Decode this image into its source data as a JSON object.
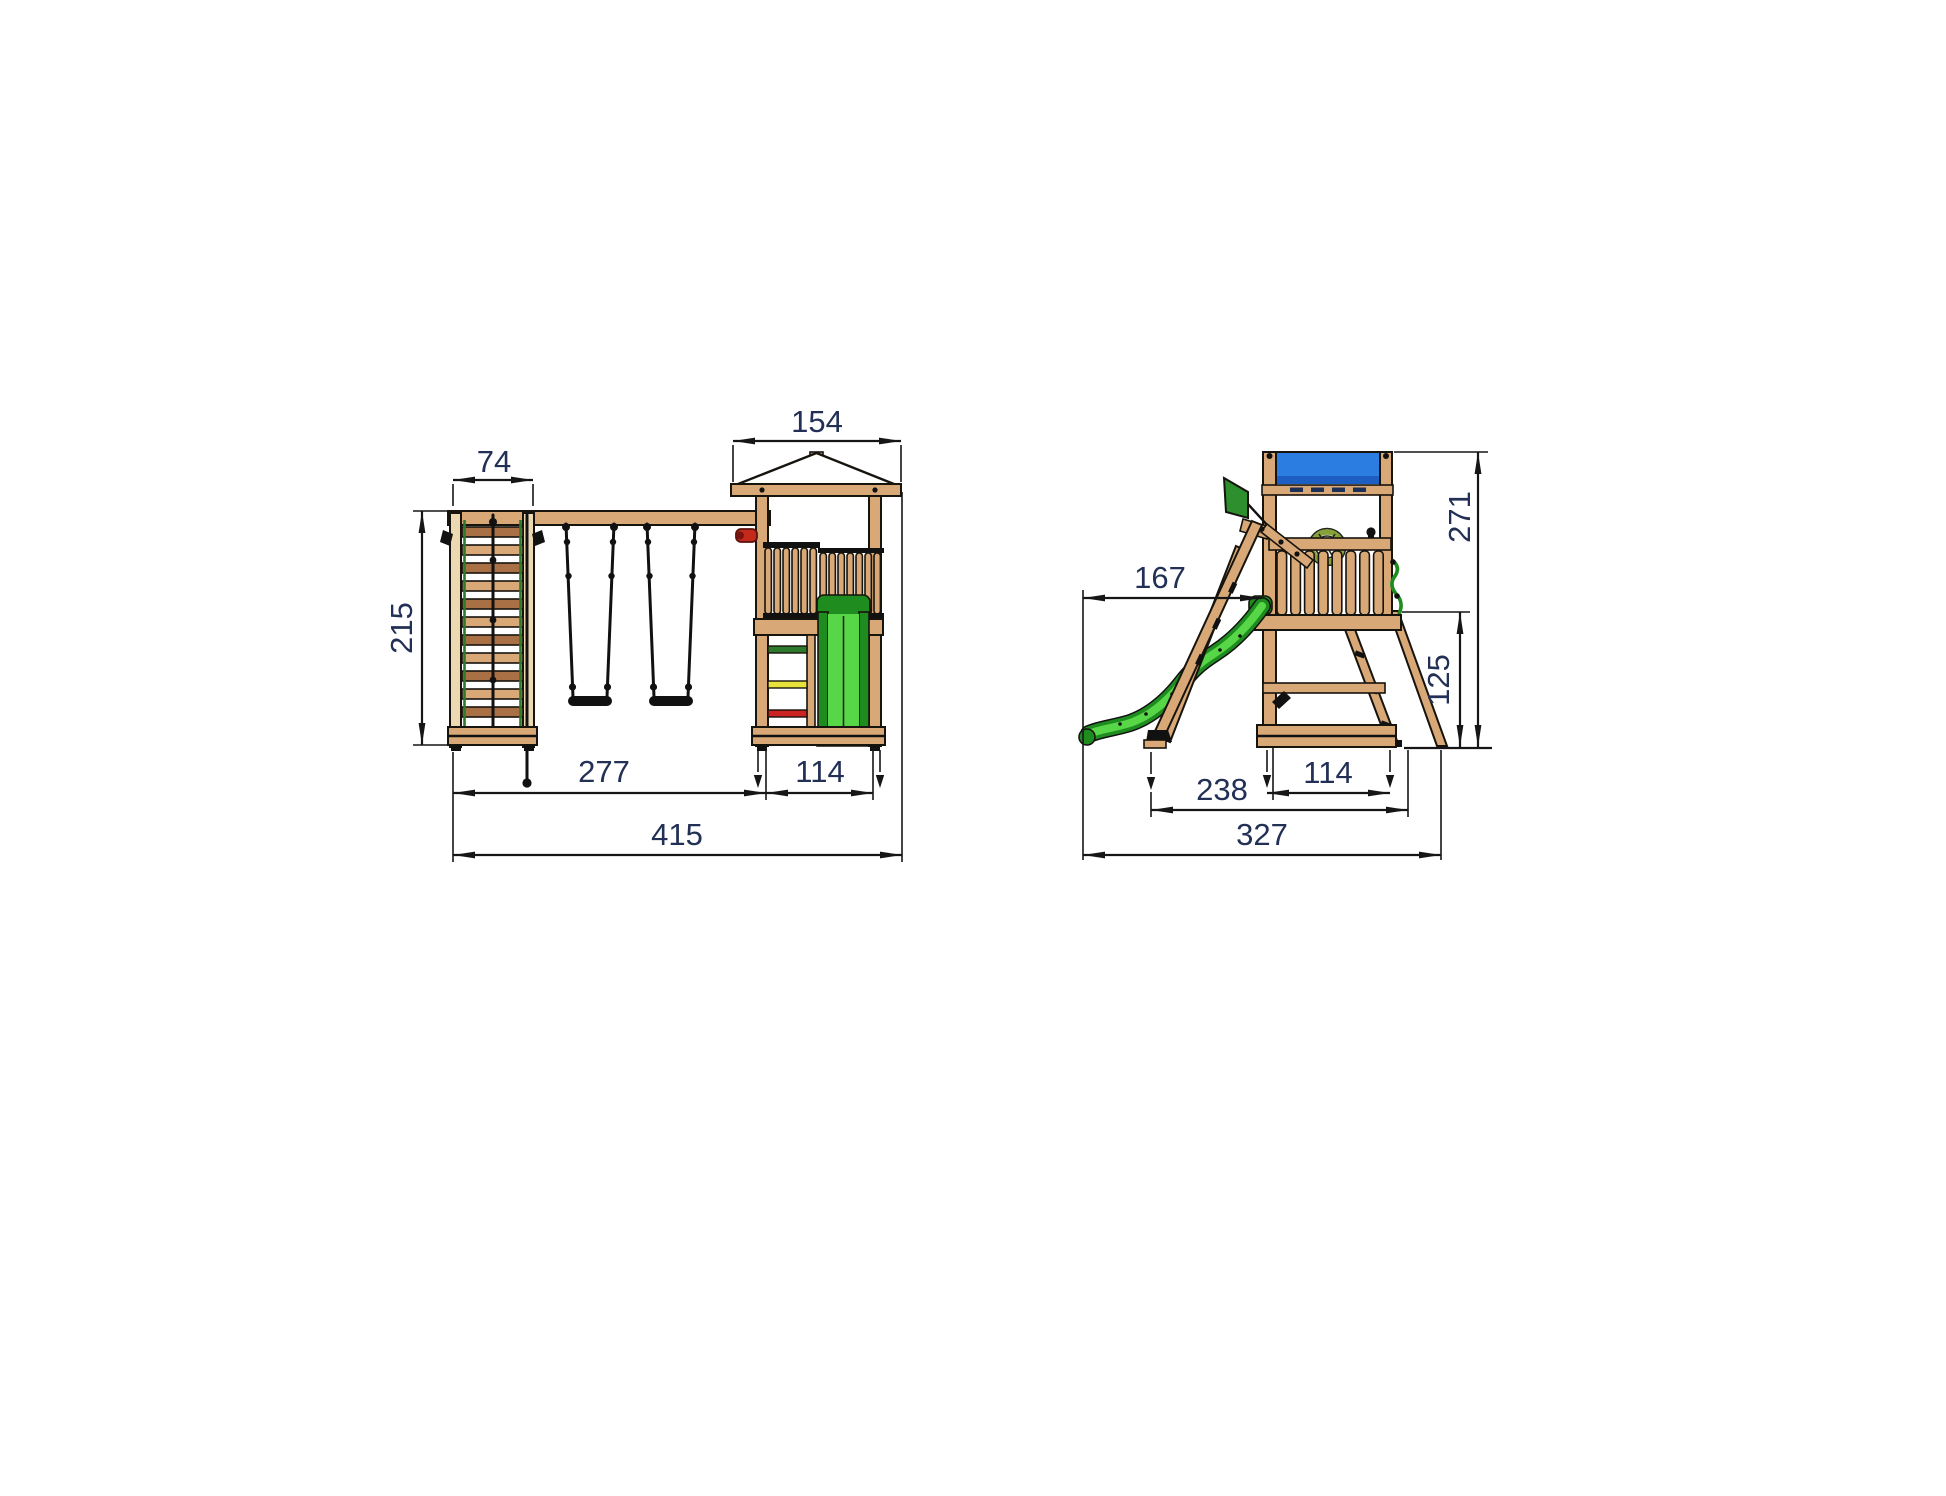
{
  "front_view": {
    "dims": {
      "frame_width": "74",
      "roof_width": "154",
      "height": "215",
      "swing_span": "277",
      "tower_width": "114",
      "total_width": "415"
    }
  },
  "side_view": {
    "dims": {
      "slide_reach": "167",
      "total_height": "271",
      "platform_height": "125",
      "ladder_depth": "238",
      "tower_depth": "114",
      "total_depth": "327"
    }
  },
  "colors": {
    "wood": "#d8a877",
    "wood_light": "#ecd9b2",
    "wood_dark": "#a97046",
    "outline": "#17130d",
    "dimension_text": "#223055",
    "dimension_line": "#161616",
    "slide_green": "#57d648",
    "slide_green_dark": "#1f8c1f",
    "banner_blue": "#2b7de2",
    "banner_blue_dark": "#1d5ec2",
    "flag_green": "#2d8f2d",
    "wheel_green": "#86a135",
    "grip_red": "#c42a1c",
    "rung_yellow": "#e8e23a",
    "rung_red": "#cc2222",
    "rung_green": "#2d7a2d",
    "rope_black": "#111111"
  }
}
